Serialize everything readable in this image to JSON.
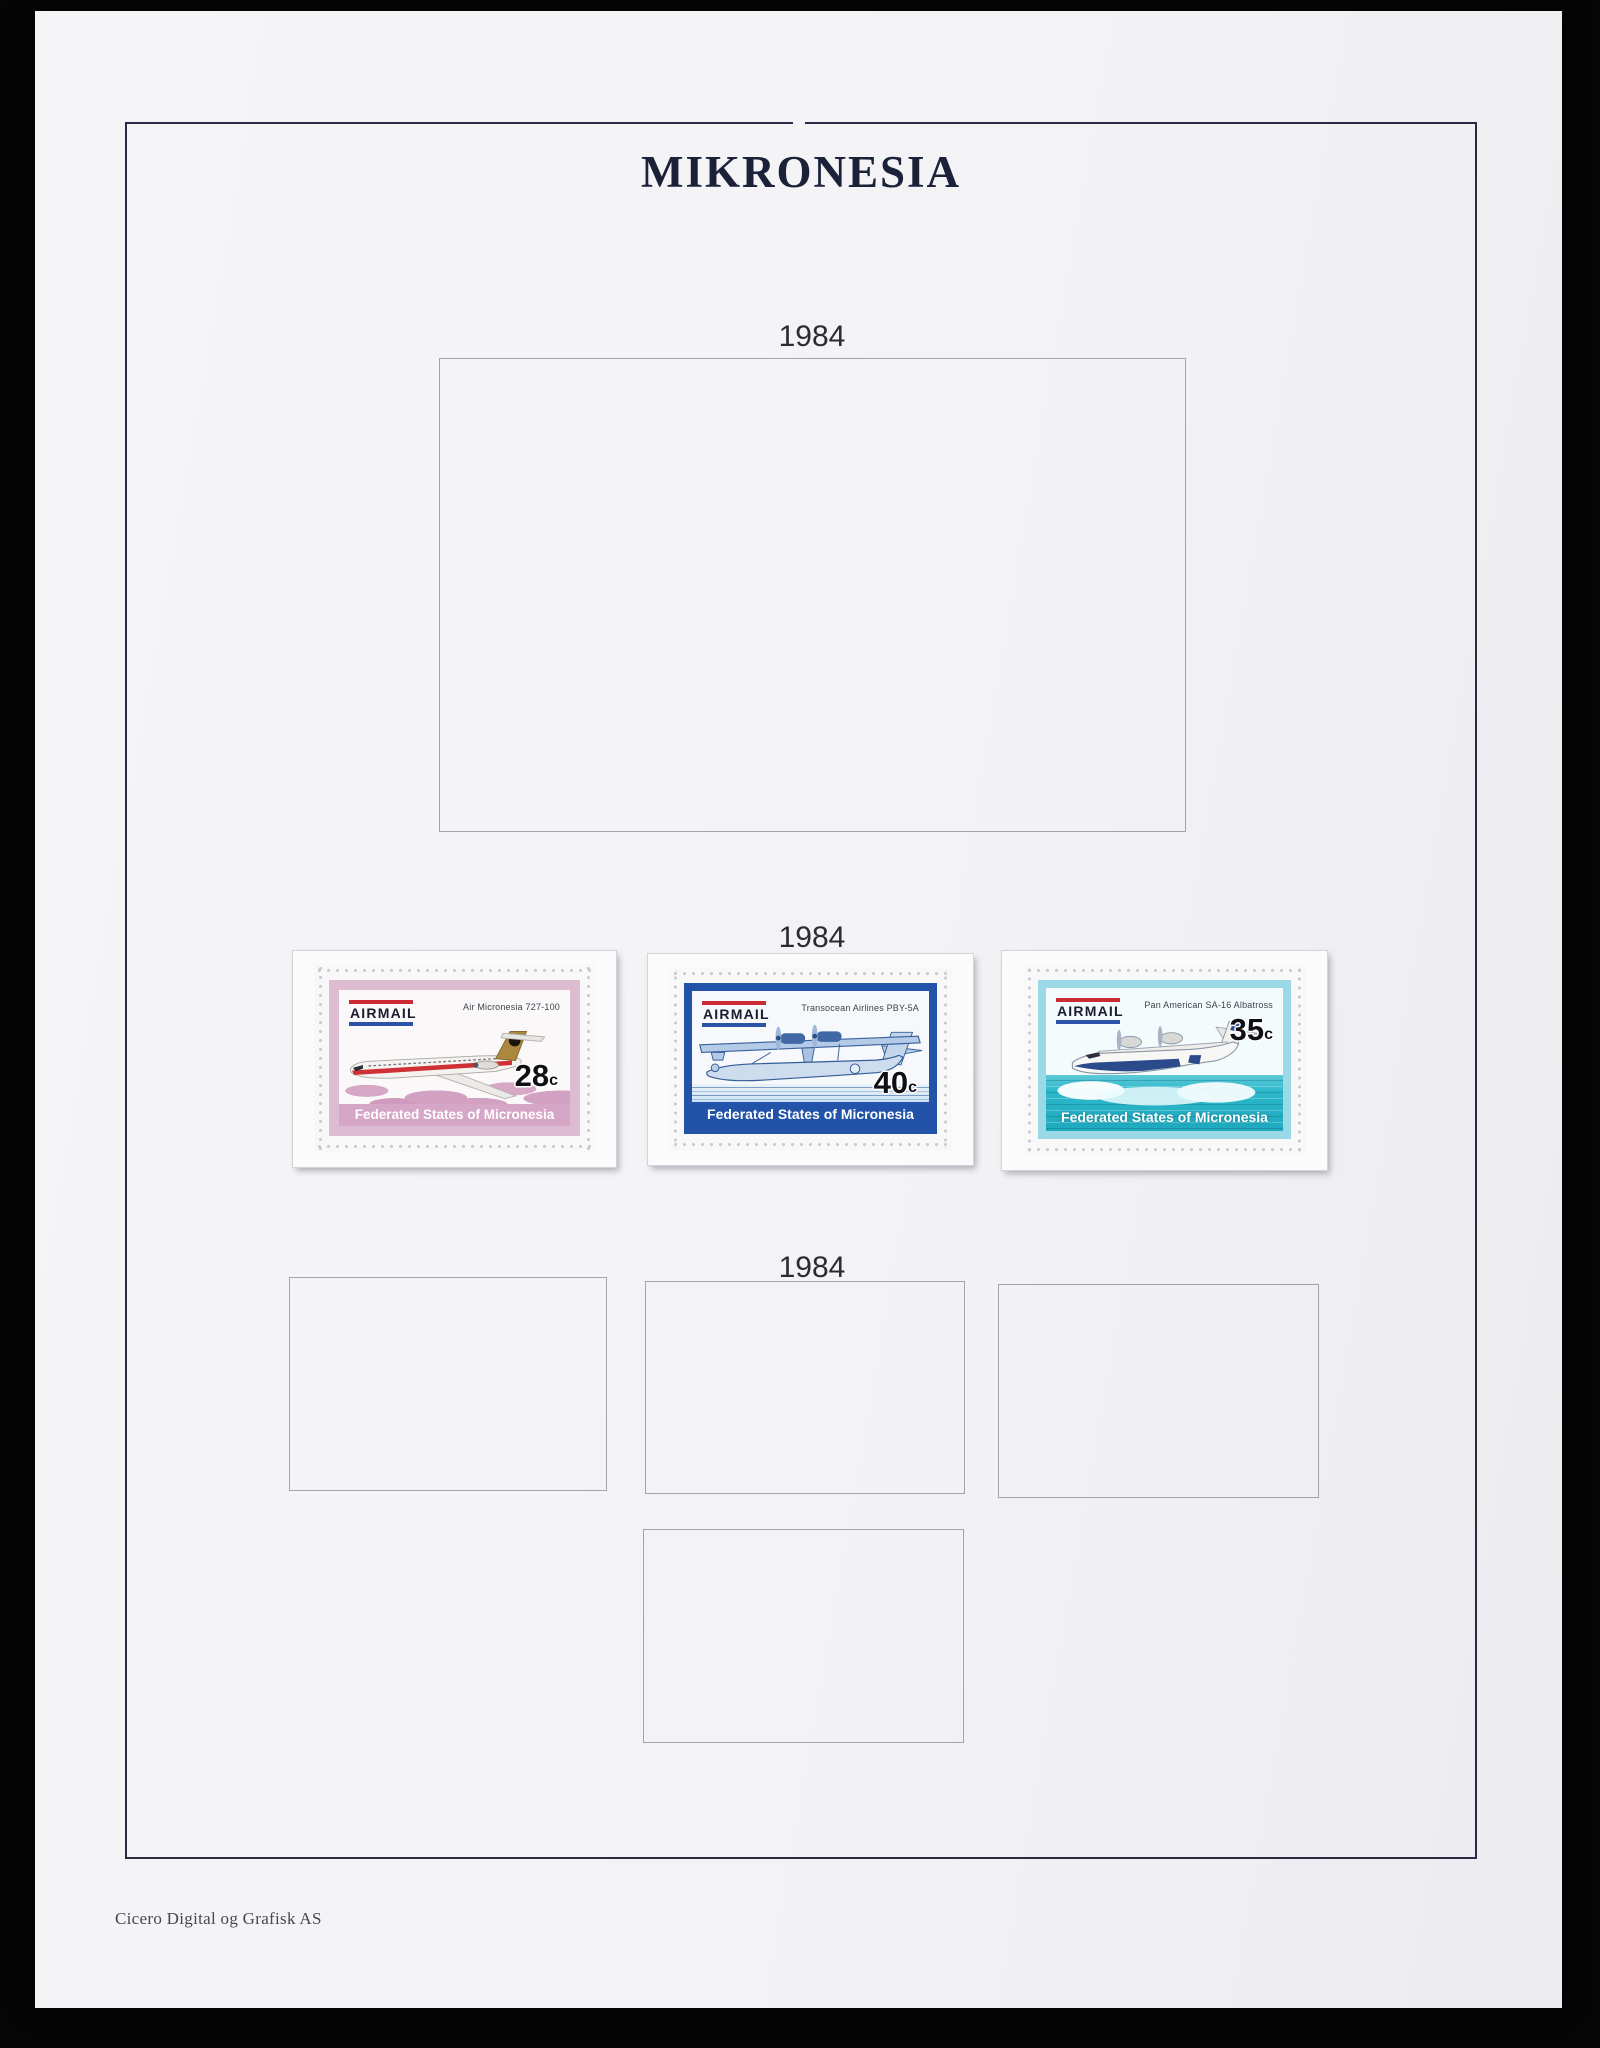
{
  "album": {
    "title": "MIKRONESIA",
    "publisher_credit": "Cicero Digital og Grafisk AS"
  },
  "sections": [
    {
      "year": "1984"
    },
    {
      "year": "1984"
    },
    {
      "year": "1984"
    }
  ],
  "stamps": [
    {
      "airmail_label": "AIRMAIL",
      "caption": "Air Micronesia 727-100",
      "denomination": "28",
      "denomination_unit": "c",
      "country_label": "Federated States of Micronesia",
      "colors": {
        "frame": "#ddbcd2",
        "band": "#d5a6c5",
        "red": "#cc2a34",
        "blue": "#2b53a8"
      }
    },
    {
      "airmail_label": "AIRMAIL",
      "caption": "Transocean Airlines PBY-5A",
      "denomination": "40",
      "denomination_unit": "c",
      "country_label": "Federated States of Micronesia",
      "colors": {
        "frame": "#2353a8",
        "band": "#2353a8",
        "red": "#cc2a34",
        "blue": "#2b53a8"
      }
    },
    {
      "airmail_label": "AIRMAIL",
      "caption": "Pan American SA-16 Albatross",
      "denomination": "35",
      "denomination_unit": "c",
      "country_label": "Federated States of Micronesia",
      "colors": {
        "frame": "#9cd9e6",
        "sea": "#2cb7cb",
        "red": "#cc2a34",
        "blue": "#2b53a8"
      }
    }
  ]
}
